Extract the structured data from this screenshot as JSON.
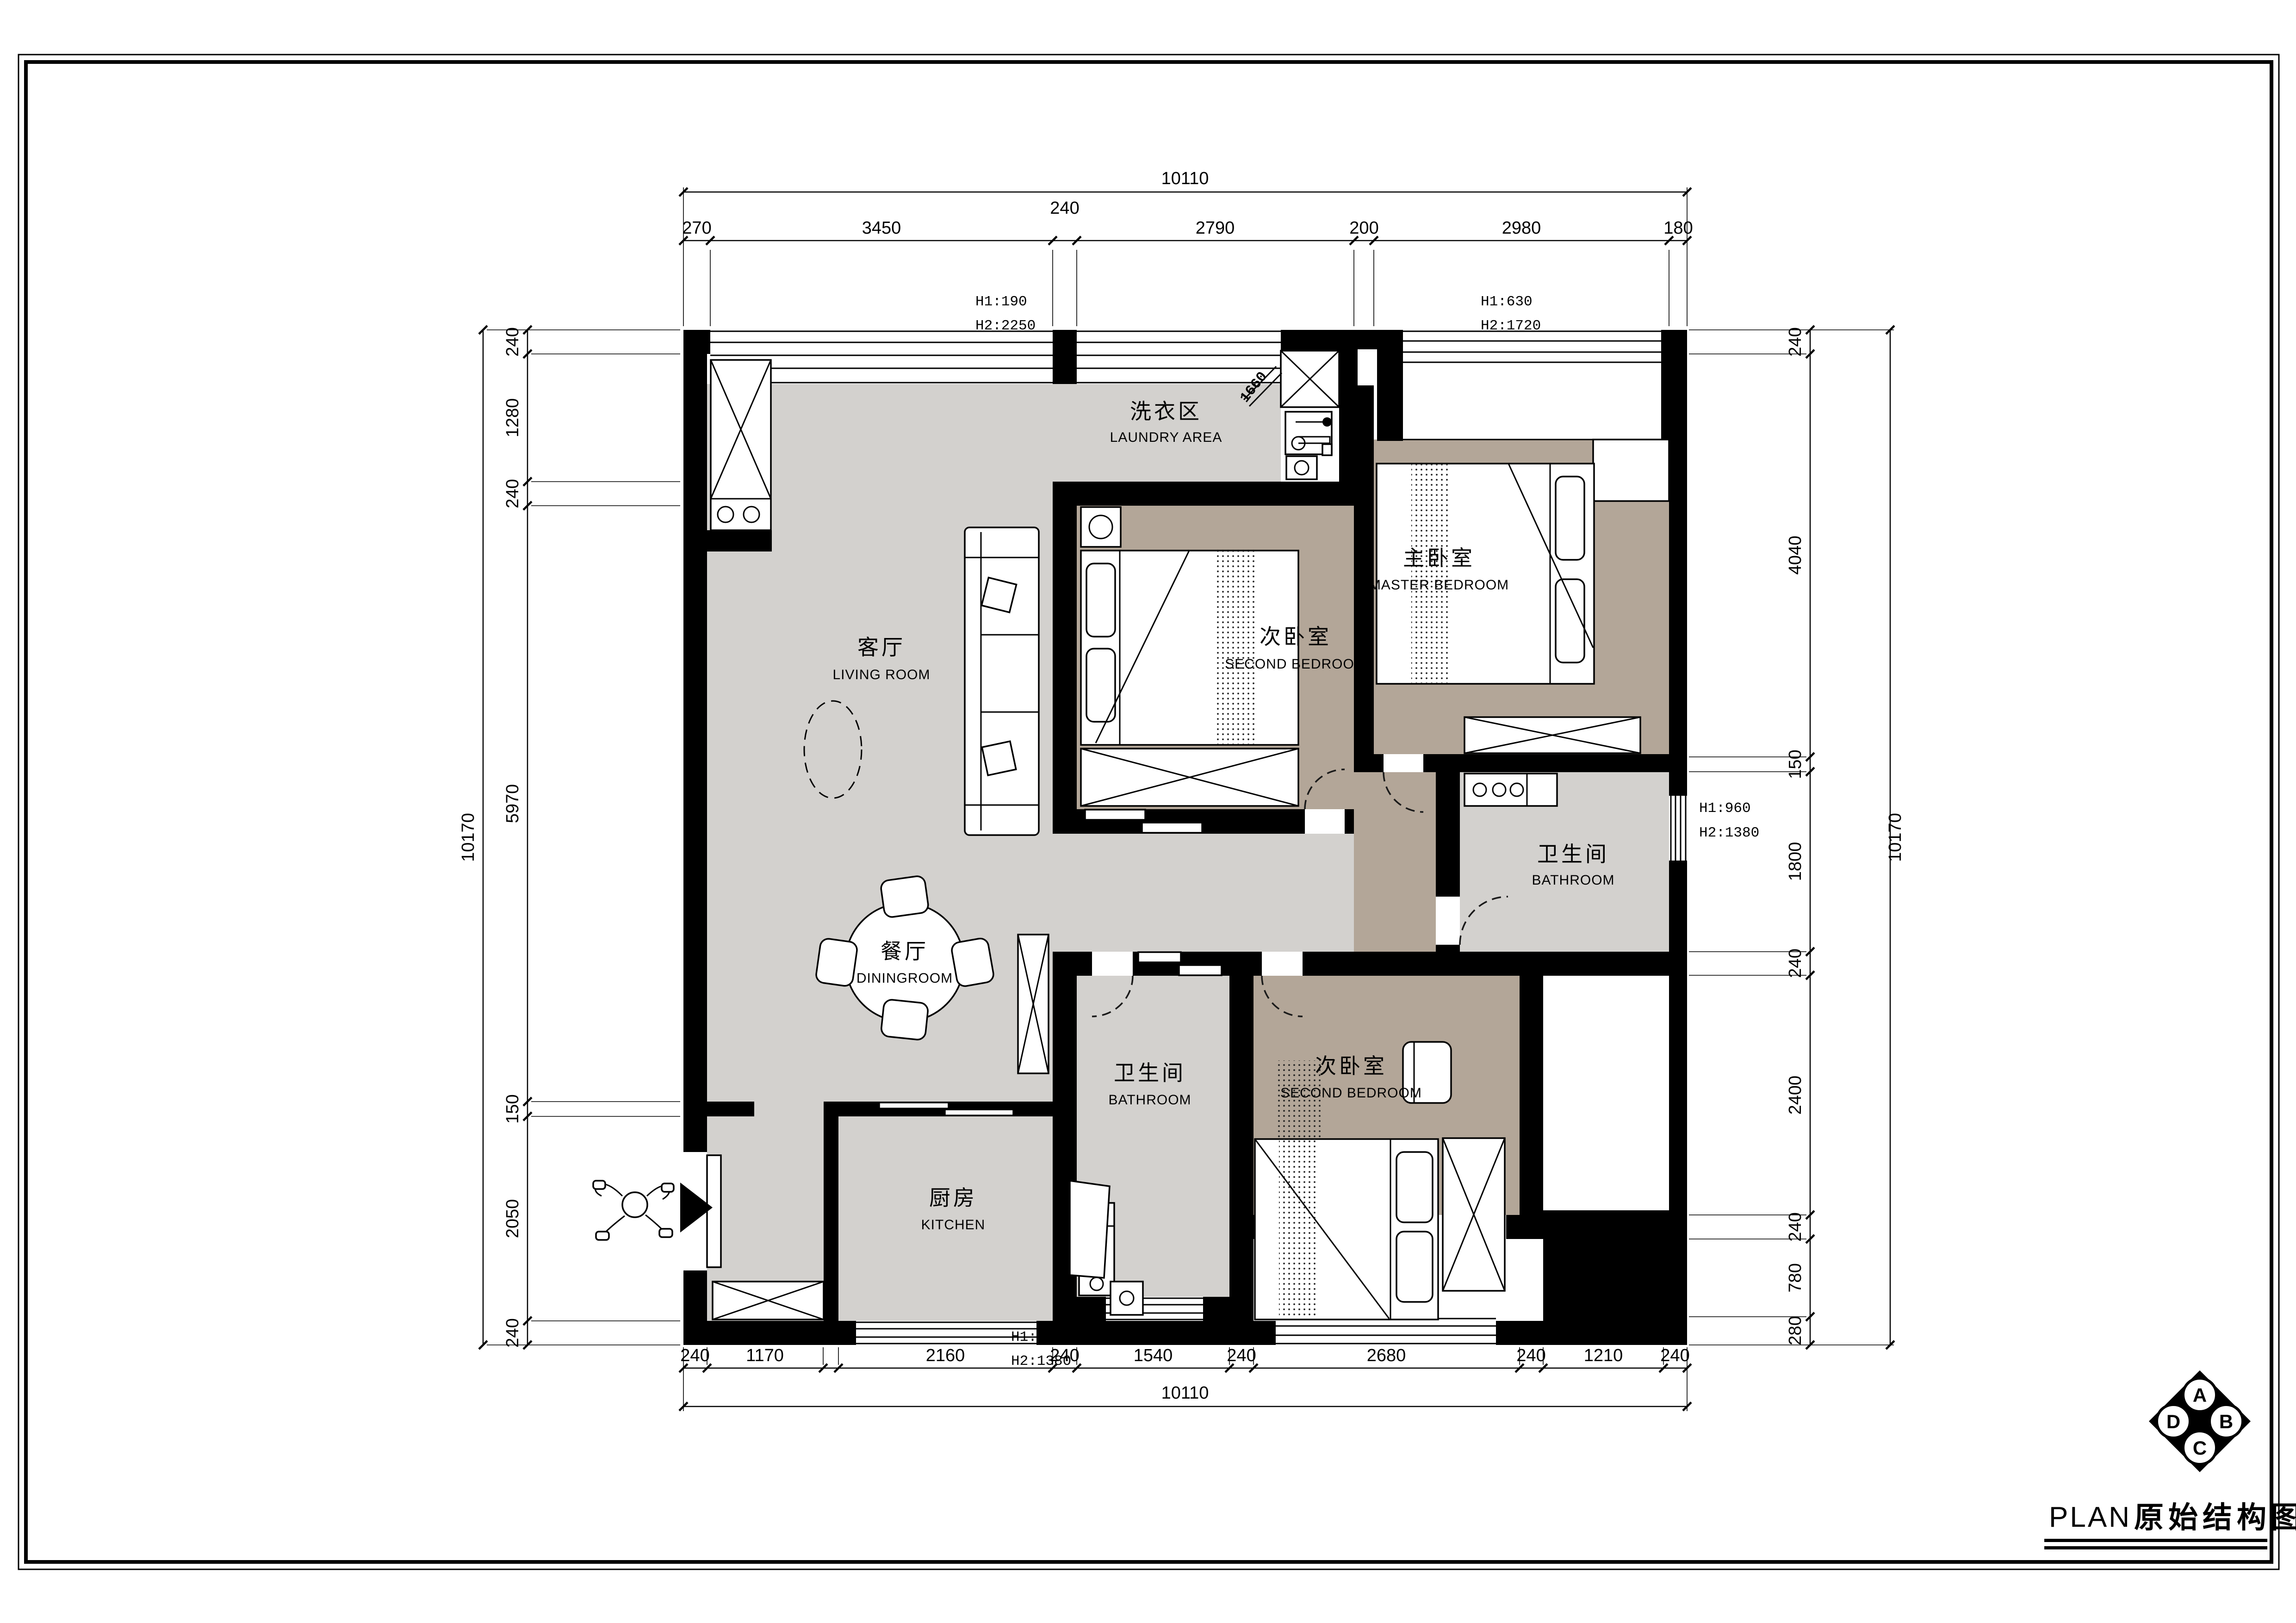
{
  "sheet": {
    "plan_label": "PLAN",
    "plan_title": "原始结构图"
  },
  "compass": {
    "a": "A",
    "b": "B",
    "c": "C",
    "d": "D"
  },
  "rooms": {
    "living": {
      "zh": "客厅",
      "en": "LIVING ROOM"
    },
    "dining": {
      "zh": "餐厅",
      "en": "DININGROOM"
    },
    "kitchen": {
      "zh": "厨房",
      "en": "KITCHEN"
    },
    "laundry": {
      "zh": "洗衣区",
      "en": "LAUNDRY AREA"
    },
    "bath_mid": {
      "zh": "卫生间",
      "en": "BATHROOM"
    },
    "bath_right": {
      "zh": "卫生间",
      "en": "BATHROOM"
    },
    "bed_second_top": {
      "zh": "次卧室",
      "en": "SECOND BEDROOM"
    },
    "bed_second_bottom": {
      "zh": "次卧室",
      "en": "SECOND BEDROOM"
    },
    "master": {
      "zh": "主卧室",
      "en": "MASTER BEDROOM"
    }
  },
  "annotations": {
    "top_left": {
      "l1": "H1:190",
      "l2": "H2:2250"
    },
    "top_right": {
      "l1": "H1:630",
      "l2": "H2:1720"
    },
    "right_bath": {
      "l1": "H1:960",
      "l2": "H2:1380"
    },
    "bottom": {
      "l1": "H1:960",
      "l2": "H2:1380"
    },
    "laundry_slant": "1660"
  },
  "dimensions": {
    "top_total": "10110",
    "bottom_total": "10110",
    "left_total": "10170",
    "right_total": "10170",
    "top_chain": [
      "270",
      "3450",
      "240",
      "2790",
      "200",
      "2980",
      "180"
    ],
    "bottom_chain": [
      "240",
      "1170",
      "150",
      "2160",
      "240",
      "1540",
      "240",
      "2680",
      "240",
      "1210",
      "240"
    ],
    "left_chain": [
      "240",
      "1280",
      "240",
      "5970",
      "150",
      "2050",
      "240"
    ],
    "right_chain": [
      "240",
      "4040",
      "150",
      "1800",
      "240",
      "2400",
      "240",
      "780",
      "280"
    ]
  }
}
